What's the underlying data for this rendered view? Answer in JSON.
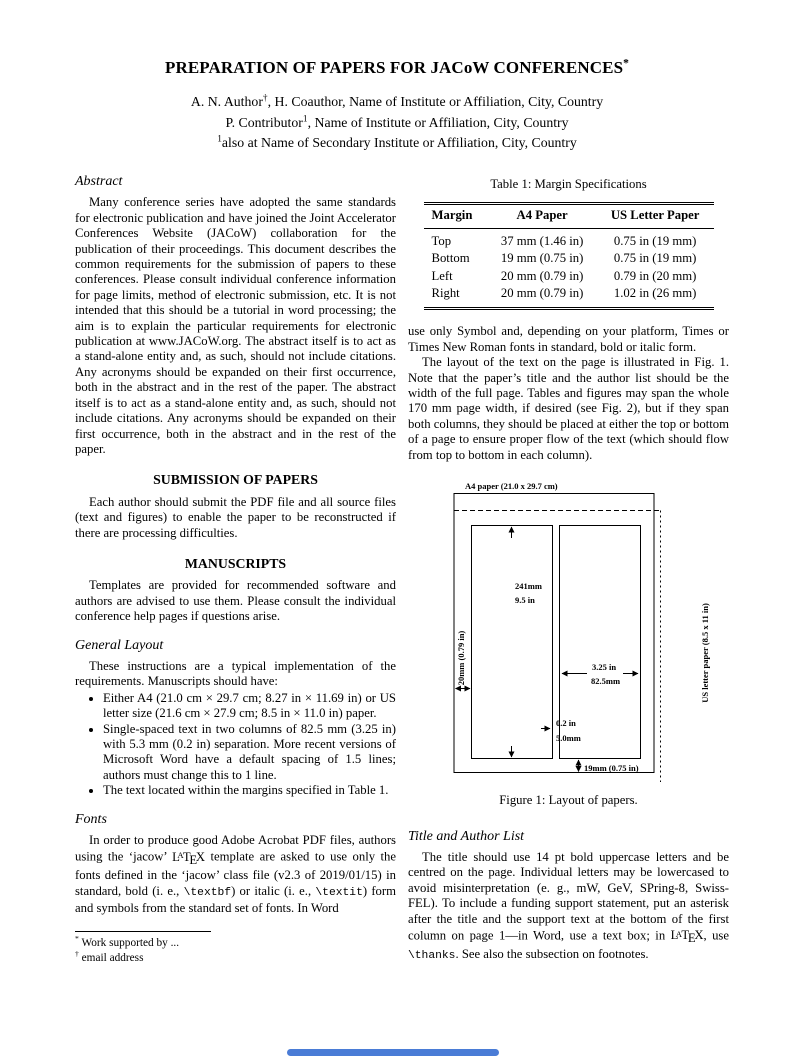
{
  "header": {
    "title": [
      {
        "t": "PREPARATION OF PAPERS FOR JACoW CONFERENCES"
      },
      {
        "t": "*",
        "s": "sup"
      }
    ],
    "authors": [
      [
        {
          "t": "A. N. Author"
        },
        {
          "t": "†",
          "s": "sup"
        },
        {
          "t": ", H. Coauthor, Name of Institute or Affiliation, City, Country"
        }
      ],
      [
        {
          "t": "P. Contributor"
        },
        {
          "t": "1",
          "s": "sup"
        },
        {
          "t": ", Name of Institute or Affiliation, City, Country"
        }
      ],
      [
        {
          "t": "1",
          "s": "sup"
        },
        {
          "t": "also at Name of Secondary Institute or Affiliation, City, Country"
        }
      ]
    ]
  },
  "left": {
    "abstract_heading": "Abstract",
    "abstract_p": "Many conference series have adopted the same standards for electronic publication and have joined the Joint Accelerator Conferences Website (JACoW) collaboration for the publication of their proceedings. This document describes the common requirements for the submission of papers to these conferences. Please consult individual conference information for page limits, method of electronic submission, etc. It is not intended that this should be a tutorial in word processing; the aim is to explain the particular requirements for electronic publication at www.JACoW.org. The abstract itself is to act as a stand-alone entity and, as such, should not include citations. Any acronyms should be expanded on their first occurrence, both in the abstract and in the rest of the paper. The abstract itself is to act as a stand-alone entity and, as such, should not include citations. Any acronyms should be expanded on their first occurrence, both in the abstract and in the rest of the paper.",
    "submission_heading": "SUBMISSION OF PAPERS",
    "submission_p": "Each author should submit the PDF file and all source files (text and figures) to enable the paper to be reconstructed if there are processing difficulties.",
    "manuscripts_heading": "MANUSCRIPTS",
    "manuscripts_p": "Templates are provided for recommended software and authors are advised to use them. Please consult the individual conference help pages if questions arise.",
    "general_layout_heading": "General Layout",
    "general_layout_intro": "These instructions are a typical implementation of the requirements. Manuscripts should have:",
    "bullets": [
      "Either A4 (21.0 cm × 29.7 cm; 8.27 in × 11.69 in) or US letter size (21.6 cm × 27.9 cm; 8.5 in × 11.0 in) paper.",
      "Single-spaced text in two columns of 82.5 mm (3.25 in) with 5.3 mm (0.2 in) separation. More recent versions of Microsoft Word have a default spacing of 1.5 lines; authors must change this to 1 line.",
      "The text located within the margins specified in Table 1."
    ],
    "fonts_heading": "Fonts",
    "fonts_p": [
      {
        "t": "In order to produce good Adobe Acrobat PDF files, authors using the ‘jacow’ "
      },
      {
        "t": "LATEX",
        "s": "latex"
      },
      {
        "t": " template are asked to use only the fonts defined in the ‘jacow’ class file (v2.3 of 2019/01/15) in standard, bold (i. e., "
      },
      {
        "t": "\\textbf",
        "s": "mono"
      },
      {
        "t": ") or italic (i. e., "
      },
      {
        "t": "\\textit",
        "s": "mono"
      },
      {
        "t": ") form and symbols from the standard set of fonts. In Word"
      }
    ],
    "footnotes": [
      [
        {
          "t": "*",
          "s": "sup"
        },
        {
          "t": " Work supported by ..."
        }
      ],
      [
        {
          "t": "†",
          "s": "sup"
        },
        {
          "t": " email address"
        }
      ]
    ]
  },
  "right": {
    "table1": {
      "caption": "Table 1: Margin Specifications",
      "headers": [
        "Margin",
        "A4 Paper",
        "US Letter Paper"
      ],
      "rows": [
        [
          "Top",
          "37 mm (1.46 in)",
          "0.75 in (19 mm)"
        ],
        [
          "Bottom",
          "19 mm (0.75 in)",
          "0.75 in (19 mm)"
        ],
        [
          "Left",
          "20 mm (0.79 in)",
          "0.79 in (20 mm)"
        ],
        [
          "Right",
          "20 mm (0.79 in)",
          "1.02 in (26 mm)"
        ]
      ]
    },
    "p1": "use only Symbol and, depending on your platform, Times or Times New Roman fonts in standard, bold or italic form.",
    "p2": "The layout of the text on the page is illustrated in Fig. 1. Note that the paper’s title and the author list should be the width of the full page. Tables and figures may span the whole 170 mm page width, if desired (see Fig. 2), but if they span both columns, they should be placed at either the top or bottom of a page to ensure proper flow of the text (which should flow from top to bottom in each column).",
    "figure1": {
      "paper_label": "A4 paper (21.0 x 29.7 cm)",
      "col_height_mm": "241mm",
      "col_height_in": "9.5 in",
      "left_margin": "20mm (0.79 in)",
      "right_label": "US letter paper (8.5 x 11 in)",
      "col_width_in": "3.25 in",
      "col_width_mm": "82.5mm",
      "gap_in": "0.2 in",
      "gap_mm": "5.0mm",
      "bottom_margin": "19mm (0.75 in)",
      "caption": "Figure 1: Layout of papers."
    },
    "title_author_heading": "Title and Author List",
    "title_author_p": [
      {
        "t": "The title should use 14 pt bold uppercase letters and be centred on the page. Individual letters may be lowercased to avoid misinterpretation (e. g., mW, GeV, SPring-8, Swiss-FEL). To include a funding support statement, put an asterisk after the title and the support text at the bottom of the first column on page 1—in Word, use a text box; in "
      },
      {
        "t": "LATEX",
        "s": "latex"
      },
      {
        "t": ", use "
      },
      {
        "t": "\\thanks",
        "s": "mono"
      },
      {
        "t": ". See also the subsection on footnotes."
      }
    ]
  },
  "footer": {
    "indicator_color": "#4a7cd6"
  }
}
